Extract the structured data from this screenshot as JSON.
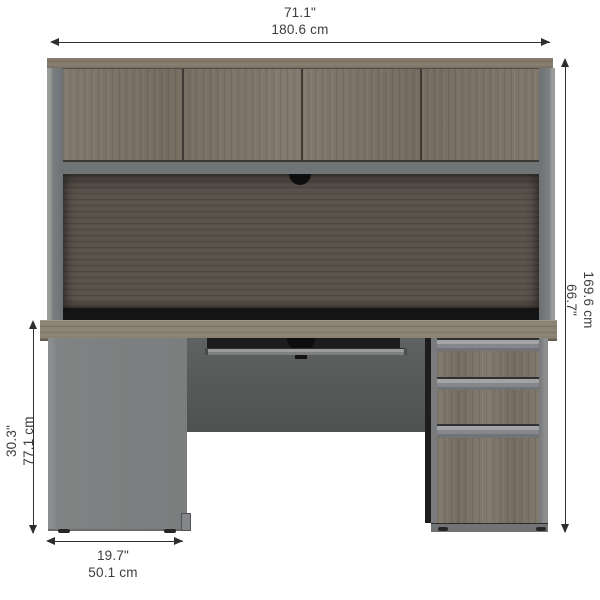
{
  "product_diagram": {
    "description": "desk-with-hutch-dimension-diagram",
    "dimensions": {
      "overall_width": {
        "inches": "71.1\"",
        "cm": "180.6 cm"
      },
      "overall_height": {
        "inches": "66.7\"",
        "cm": "169.6 cm"
      },
      "desk_height": {
        "inches": "30.3\"",
        "cm": "77.1 cm"
      },
      "pedestal_width": {
        "inches": "19.7\"",
        "cm": "50.1 cm"
      }
    },
    "colors": {
      "wood_bark_gray": "#7b7266",
      "wood_desk_top": "#8c8274",
      "wood_back_panel": "#59524b",
      "slate_gray_panel": "#7f8182",
      "modesty_panel_gray": "#595b5b",
      "shadow_black": "#141414",
      "dimension_line": "#2e2e2e",
      "label_text": "#3d3d3d",
      "background": "#ffffff"
    }
  }
}
